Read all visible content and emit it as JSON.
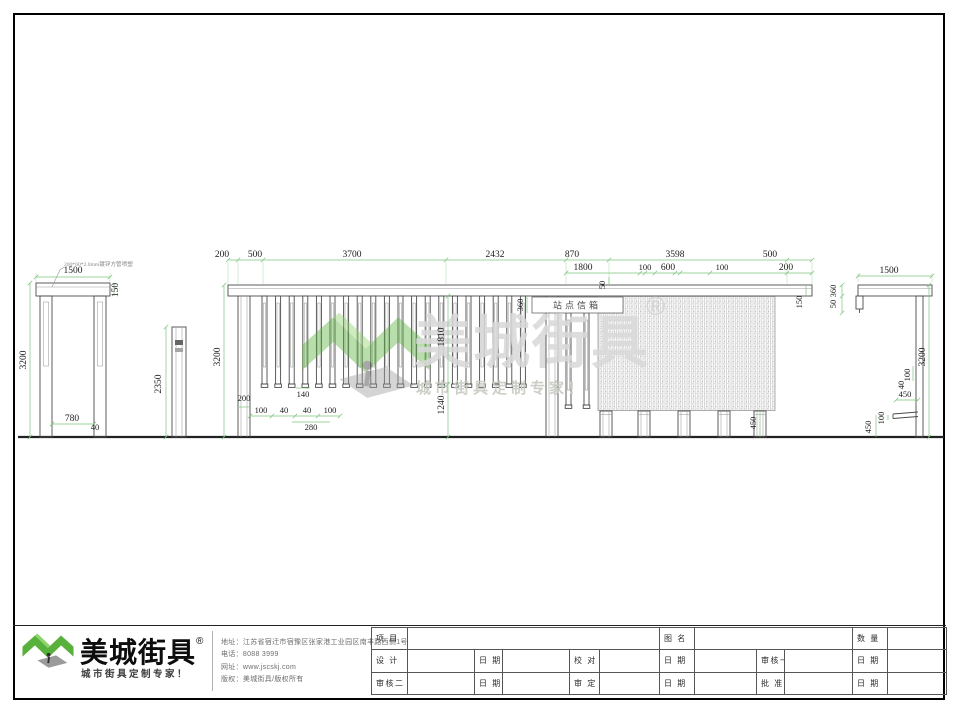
{
  "watermark": {
    "brand": "美城街具",
    "reg": "®",
    "tagline": "城市街具定制专家！"
  },
  "annotations": {
    "leader": "200*60*2.0mm镀锌方管喷塑",
    "sign": "站点信箱"
  },
  "dims": {
    "left": {
      "w": "1500",
      "beam": "150",
      "h": "3200",
      "inner": "780",
      "off": "40"
    },
    "mid": {
      "h": "2350"
    },
    "main_top": [
      "200",
      "500",
      "3700",
      "2432",
      "870",
      "3598",
      "500"
    ],
    "main_row2": [
      "1800",
      "100",
      "600",
      "100",
      "200"
    ],
    "main_v": {
      "h": "3200",
      "post": "200",
      "sign": "360",
      "gap": "50",
      "slat": "1810",
      "lower": "1240",
      "beam": "150",
      "batten": "450"
    },
    "main_b": {
      "s140": "140",
      "s100a": "100",
      "s40a": "40",
      "s40b": "40",
      "s100b": "100",
      "s280": "280"
    },
    "right_v": {
      "w": "1500",
      "p360": "360",
      "p50": "50",
      "h": "3200",
      "t100": "100",
      "t40": "40",
      "seat": "450",
      "thick": "100",
      "height": "450"
    }
  },
  "footer": {
    "brand": "美城街具",
    "reg": "®",
    "tagline": "城市街具定制专家！",
    "info": [
      "地址：江苏省宿迁市宿豫区张家港工业园区南丰路西侧1号",
      "电话：8088 3999",
      "网址：www.jscskj.com",
      "版权：美城街具/版权所有"
    ],
    "table": {
      "project": "项 目",
      "drawing_name": "图 名",
      "quantity": "数 量",
      "design": "设 计",
      "date": "日 期",
      "proofread": "校 对",
      "review1": "审核一",
      "review2": "审核二",
      "approve": "审 定",
      "ratify": "批 准"
    }
  }
}
